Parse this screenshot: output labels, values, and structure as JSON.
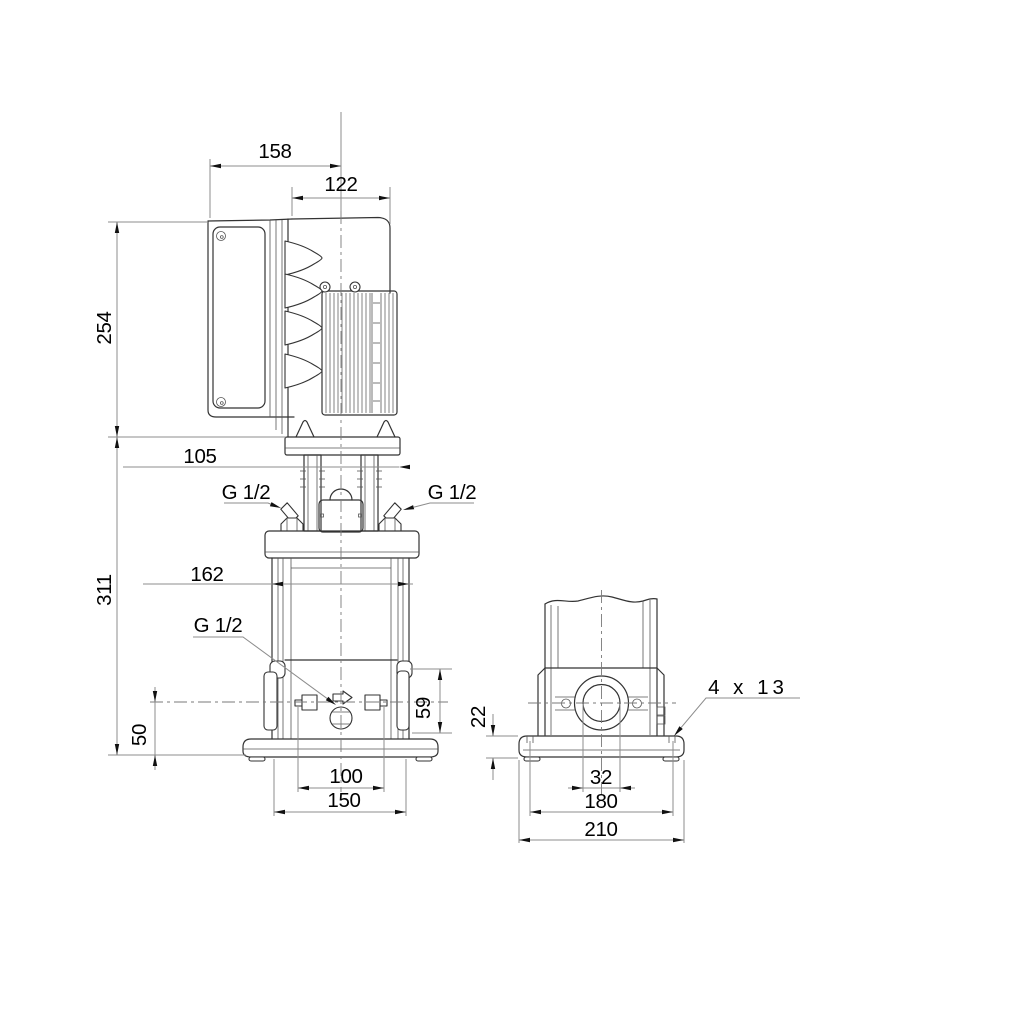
{
  "drawing": {
    "description": "Vertical multistage centrifugal pump - dimensional drawing with side view and end view",
    "units": "mm",
    "colors": {
      "outline": "#333333",
      "dimension_lines": "#8c8c8c",
      "text": "#000000",
      "background": "#ffffff"
    },
    "side_view": {
      "dim_overall_width": "158",
      "dim_motor_width": "122",
      "dim_motor_height": "254",
      "dim_head_width": "105",
      "dim_pump_height": "311",
      "dim_coupling_diameter": "162",
      "dim_port_center_height": "50",
      "dim_outlet_height": "59",
      "dim_plug_span": "100",
      "dim_base_width": "150",
      "label_gauge_port_left": "G 1/2",
      "label_gauge_port_right": "G 1/2",
      "label_drain_port": "G 1/2"
    },
    "end_view": {
      "dim_port_bore": "32",
      "dim_bolt_span": "180",
      "dim_base_width": "210",
      "dim_base_plate_thickness": "22",
      "label_mounting_holes": "4 x 13"
    }
  }
}
